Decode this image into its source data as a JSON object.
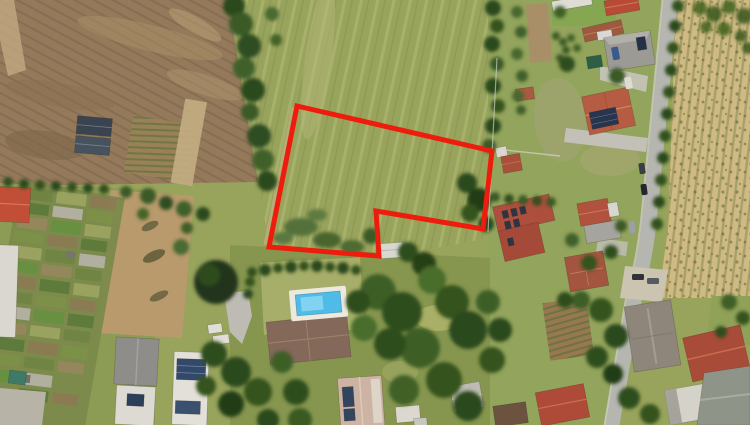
{
  "meta": {
    "type": "satellite-aerial-photo",
    "description": "Aerial satellite view of suburban land parcels: a red six-vertex outline marks an irregular grass parcel in the central meadow, bordered by a plowed field and allotment gardens on the left, a tree-lined lane, houses with red and gray roofs along a street on the right, a harvested tan field at far right, and gardens with a swimming pool below the parcel."
  },
  "annotation": {
    "parcel_outline": {
      "points": "297,106 492,151 483,229 376,211 379,256 269,247",
      "vertices": [
        [
          297,
          106
        ],
        [
          492,
          151
        ],
        [
          483,
          229
        ],
        [
          376,
          211
        ],
        [
          379,
          256
        ],
        [
          269,
          247
        ]
      ],
      "stroke_color": "#ed1c0c",
      "stroke_width": 5
    }
  },
  "palette": {
    "meadow": "#98a35c",
    "meadow_stripe": "#aab168",
    "plowed_field": "#94795b",
    "harvested_field": "#cfba83",
    "dry_meadow": "#b89a6c",
    "lawn": "#93a45c",
    "road": "#b5b6b0",
    "tree_dark": "#2e4a1f",
    "tree_mid": "#41602a",
    "pool_water": "#4fbce8",
    "pool_deck": "#eceadf",
    "roof_red": "#b2503c",
    "roof_terracotta": "#b65c42",
    "roof_gray": "#9a9894",
    "solar_panel": "#2c3e55",
    "greenhouse_dark": "#3a4450"
  },
  "features": [
    {
      "name": "outlined-parcel",
      "kind": "annotation"
    },
    {
      "name": "grass-meadow",
      "kind": "terrain"
    },
    {
      "name": "plowed-field",
      "kind": "terrain"
    },
    {
      "name": "harvested-field",
      "kind": "terrain"
    },
    {
      "name": "allotment-gardens",
      "kind": "terrain"
    },
    {
      "name": "residential-street",
      "kind": "road"
    },
    {
      "name": "houses",
      "kind": "building"
    },
    {
      "name": "swimming-pool",
      "kind": "amenity"
    },
    {
      "name": "tree-lines",
      "kind": "vegetation"
    }
  ]
}
